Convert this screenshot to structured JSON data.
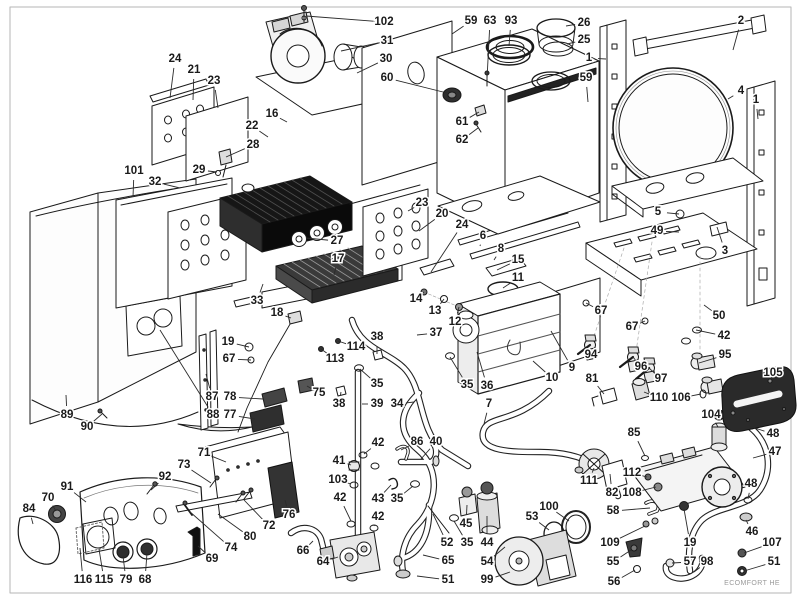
{
  "diagram": {
    "watermark": "ECOMFORT HE",
    "colors": {
      "ink": "#1a1a1a",
      "leader": "#2b2b2b",
      "halo": "#ffffff",
      "dark_part": "#262626",
      "border": "#b5b5b5"
    },
    "label_font_px": 11.5,
    "callouts": [
      {
        "n": "24",
        "x": 175,
        "y": 59,
        "tx": 170,
        "ty": 98
      },
      {
        "n": "21",
        "x": 194,
        "y": 70,
        "tx": 193,
        "ty": 100
      },
      {
        "n": "23",
        "x": 214,
        "y": 81,
        "tx": 218,
        "ty": 108
      },
      {
        "n": "102",
        "x": 384,
        "y": 22,
        "tx": 306,
        "ty": 16
      },
      {
        "n": "31",
        "x": 387,
        "y": 41,
        "tx": 341,
        "ty": 51
      },
      {
        "n": "30",
        "x": 386,
        "y": 59,
        "tx": 357,
        "ty": 73
      },
      {
        "n": "60",
        "x": 387,
        "y": 78,
        "tx": 447,
        "ty": 93
      },
      {
        "n": "59",
        "x": 471,
        "y": 21,
        "tx": 452,
        "ty": 34
      },
      {
        "n": "63",
        "x": 490,
        "y": 21,
        "tx": 487,
        "ty": 79
      },
      {
        "n": "93",
        "x": 511,
        "y": 21,
        "tx": 509,
        "ty": 46
      },
      {
        "n": "26",
        "x": 584,
        "y": 23,
        "tx": 566,
        "ty": 26
      },
      {
        "n": "25",
        "x": 584,
        "y": 40,
        "tx": 567,
        "ty": 44
      },
      {
        "n": "1",
        "x": 589,
        "y": 58,
        "tx": 606,
        "ty": 59
      },
      {
        "n": "59",
        "x": 586,
        "y": 78,
        "tx": 588,
        "ty": 102
      },
      {
        "n": "2",
        "x": 741,
        "y": 21,
        "tx": 733,
        "ty": 50
      },
      {
        "n": "4",
        "x": 741,
        "y": 91,
        "tx": 728,
        "ty": 99
      },
      {
        "n": "1",
        "x": 756,
        "y": 100,
        "tx": 758,
        "ty": 119
      },
      {
        "n": "16",
        "x": 272,
        "y": 114,
        "tx": 287,
        "ty": 122
      },
      {
        "n": "22",
        "x": 252,
        "y": 126,
        "tx": 268,
        "ty": 137
      },
      {
        "n": "28",
        "x": 253,
        "y": 145,
        "tx": 226,
        "ty": 157
      },
      {
        "n": "29",
        "x": 199,
        "y": 170,
        "tx": 217,
        "ty": 172
      },
      {
        "n": "101",
        "x": 134,
        "y": 171,
        "tx": 133,
        "ty": 197
      },
      {
        "n": "32",
        "x": 155,
        "y": 182,
        "tx": 180,
        "ty": 188
      },
      {
        "n": "61",
        "x": 462,
        "y": 122,
        "tx": 479,
        "ty": 112
      },
      {
        "n": "62",
        "x": 462,
        "y": 140,
        "tx": 478,
        "ty": 128
      },
      {
        "n": "5",
        "x": 658,
        "y": 212,
        "tx": 679,
        "ty": 214
      },
      {
        "n": "49",
        "x": 657,
        "y": 231,
        "tx": 679,
        "ty": 232
      },
      {
        "n": "3",
        "x": 725,
        "y": 251,
        "tx": 717,
        "ty": 227
      },
      {
        "n": "27",
        "x": 337,
        "y": 241,
        "tx": 306,
        "ty": 238
      },
      {
        "n": "23",
        "x": 422,
        "y": 203,
        "tx": 408,
        "ty": 211
      },
      {
        "n": "20",
        "x": 442,
        "y": 214,
        "tx": 419,
        "ty": 231
      },
      {
        "n": "24",
        "x": 462,
        "y": 225,
        "tx": 431,
        "ty": 272
      },
      {
        "n": "6",
        "x": 483,
        "y": 236,
        "tx": 480,
        "ty": 246
      },
      {
        "n": "8",
        "x": 501,
        "y": 249,
        "tx": 494,
        "ty": 260
      },
      {
        "n": "15",
        "x": 518,
        "y": 260,
        "tx": 497,
        "ty": 270
      },
      {
        "n": "11",
        "x": 518,
        "y": 278,
        "tx": 503,
        "ty": 288
      },
      {
        "n": "17",
        "x": 338,
        "y": 259,
        "tx": 334,
        "ty": 275
      },
      {
        "n": "33",
        "x": 257,
        "y": 301,
        "tx": 263,
        "ty": 284
      },
      {
        "n": "18",
        "x": 277,
        "y": 313,
        "tx": 291,
        "ty": 318
      },
      {
        "n": "14",
        "x": 416,
        "y": 299,
        "tx": 424,
        "ty": 292
      },
      {
        "n": "13",
        "x": 435,
        "y": 311,
        "tx": 444,
        "ty": 299
      },
      {
        "n": "12",
        "x": 455,
        "y": 322,
        "tx": 459,
        "ty": 307
      },
      {
        "n": "37",
        "x": 436,
        "y": 333,
        "tx": 417,
        "ty": 335
      },
      {
        "n": "19",
        "x": 228,
        "y": 342,
        "tx": 249,
        "ty": 347
      },
      {
        "n": "67",
        "x": 229,
        "y": 359,
        "tx": 251,
        "ty": 360
      },
      {
        "n": "38",
        "x": 377,
        "y": 337,
        "tx": 377,
        "ty": 354
      },
      {
        "n": "114",
        "x": 356,
        "y": 347,
        "tx": 338,
        "ty": 341
      },
      {
        "n": "113",
        "x": 335,
        "y": 359,
        "tx": 321,
        "ty": 349
      },
      {
        "n": "75",
        "x": 319,
        "y": 393,
        "tx": 307,
        "ty": 386
      },
      {
        "n": "35",
        "x": 377,
        "y": 384,
        "tx": 360,
        "ty": 369
      },
      {
        "n": "38",
        "x": 339,
        "y": 404,
        "tx": 341,
        "ty": 392
      },
      {
        "n": "39",
        "x": 377,
        "y": 404,
        "tx": 362,
        "ty": 404
      },
      {
        "n": "34",
        "x": 397,
        "y": 404,
        "tx": 414,
        "ty": 402
      },
      {
        "n": "35",
        "x": 467,
        "y": 385,
        "tx": 450,
        "ty": 357
      },
      {
        "n": "36",
        "x": 487,
        "y": 386,
        "tx": 477,
        "ty": 352
      },
      {
        "n": "10",
        "x": 552,
        "y": 378,
        "tx": 533,
        "ty": 361
      },
      {
        "n": "9",
        "x": 572,
        "y": 368,
        "tx": 551,
        "ty": 331
      },
      {
        "n": "7",
        "x": 489,
        "y": 404,
        "tx": 484,
        "ty": 424
      },
      {
        "n": "50",
        "x": 719,
        "y": 316,
        "tx": 704,
        "ty": 305
      },
      {
        "n": "67",
        "x": 601,
        "y": 311,
        "tx": 586,
        "ty": 303
      },
      {
        "n": "67",
        "x": 632,
        "y": 327,
        "tx": 645,
        "ty": 321
      },
      {
        "n": "42",
        "x": 724,
        "y": 336,
        "tx": 696,
        "ty": 330
      },
      {
        "n": "94",
        "x": 591,
        "y": 355,
        "tx": 590,
        "ty": 345
      },
      {
        "n": "96",
        "x": 641,
        "y": 367,
        "tx": 633,
        "ty": 357
      },
      {
        "n": "97",
        "x": 661,
        "y": 379,
        "tx": 649,
        "ty": 368
      },
      {
        "n": "95",
        "x": 725,
        "y": 355,
        "tx": 699,
        "ty": 363
      },
      {
        "n": "81",
        "x": 592,
        "y": 379,
        "tx": 604,
        "ty": 394
      },
      {
        "n": "110",
        "x": 659,
        "y": 398,
        "tx": 644,
        "ty": 392
      },
      {
        "n": "106",
        "x": 681,
        "y": 398,
        "tx": 701,
        "ty": 394
      },
      {
        "n": "104",
        "x": 711,
        "y": 415,
        "tx": 718,
        "ty": 427
      },
      {
        "n": "105",
        "x": 773,
        "y": 373,
        "tx": 756,
        "ty": 384
      },
      {
        "n": "87",
        "x": 212,
        "y": 397,
        "tx": 206,
        "ty": 374
      },
      {
        "n": "88",
        "x": 213,
        "y": 415,
        "tx": 160,
        "ty": 330
      },
      {
        "n": "78",
        "x": 230,
        "y": 397,
        "tx": 263,
        "ty": 399
      },
      {
        "n": "77",
        "x": 230,
        "y": 415,
        "tx": 255,
        "ty": 419
      },
      {
        "n": "89",
        "x": 67,
        "y": 415,
        "tx": 66,
        "ty": 395
      },
      {
        "n": "90",
        "x": 87,
        "y": 427,
        "tx": 102,
        "ty": 414
      },
      {
        "n": "71",
        "x": 204,
        "y": 453,
        "tx": 226,
        "ty": 462
      },
      {
        "n": "73",
        "x": 184,
        "y": 465,
        "tx": 211,
        "ty": 483
      },
      {
        "n": "92",
        "x": 165,
        "y": 477,
        "tx": 151,
        "ty": 490
      },
      {
        "n": "91",
        "x": 67,
        "y": 487,
        "tx": 86,
        "ty": 502
      },
      {
        "n": "70",
        "x": 48,
        "y": 498,
        "tx": 56,
        "ty": 511
      },
      {
        "n": "84",
        "x": 29,
        "y": 509,
        "tx": 33,
        "ty": 524
      },
      {
        "n": "76",
        "x": 289,
        "y": 515,
        "tx": 285,
        "ty": 500
      },
      {
        "n": "72",
        "x": 269,
        "y": 526,
        "tx": 244,
        "ty": 500
      },
      {
        "n": "80",
        "x": 250,
        "y": 537,
        "tx": 218,
        "ty": 514
      },
      {
        "n": "74",
        "x": 231,
        "y": 548,
        "tx": 189,
        "ty": 511
      },
      {
        "n": "69",
        "x": 212,
        "y": 559,
        "tx": 198,
        "ty": 546
      },
      {
        "n": "116",
        "x": 83,
        "y": 580,
        "tx": 80,
        "ty": 548
      },
      {
        "n": "115",
        "x": 104,
        "y": 580,
        "tx": 99,
        "ty": 549
      },
      {
        "n": "79",
        "x": 126,
        "y": 580,
        "tx": 123,
        "ty": 556
      },
      {
        "n": "68",
        "x": 145,
        "y": 580,
        "tx": 147,
        "ty": 553
      },
      {
        "n": "42",
        "x": 378,
        "y": 443,
        "tx": 364,
        "ty": 454
      },
      {
        "n": "86",
        "x": 417,
        "y": 442,
        "tx": 401,
        "ty": 450
      },
      {
        "n": "40",
        "x": 436,
        "y": 442,
        "tx": 421,
        "ty": 459
      },
      {
        "n": "41",
        "x": 339,
        "y": 461,
        "tx": 351,
        "ty": 465
      },
      {
        "n": "103",
        "x": 338,
        "y": 480,
        "tx": 351,
        "ty": 484
      },
      {
        "n": "43",
        "x": 378,
        "y": 499,
        "tx": 391,
        "ty": 485
      },
      {
        "n": "35",
        "x": 397,
        "y": 499,
        "tx": 413,
        "ty": 486
      },
      {
        "n": "42",
        "x": 340,
        "y": 498,
        "tx": 351,
        "ty": 521
      },
      {
        "n": "42",
        "x": 378,
        "y": 517,
        "tx": 374,
        "ty": 526
      },
      {
        "n": "66",
        "x": 303,
        "y": 551,
        "tx": 313,
        "ty": 541
      },
      {
        "n": "64",
        "x": 323,
        "y": 562,
        "tx": 338,
        "ty": 557
      },
      {
        "n": "65",
        "x": 448,
        "y": 561,
        "tx": 423,
        "ty": 555
      },
      {
        "n": "51",
        "x": 448,
        "y": 580,
        "tx": 417,
        "ty": 576
      },
      {
        "n": "52",
        "x": 447,
        "y": 543,
        "tx": 433,
        "ty": 514
      },
      {
        "n": "35",
        "x": 467,
        "y": 543,
        "tx": 454,
        "ty": 521
      },
      {
        "n": "45",
        "x": 466,
        "y": 524,
        "tx": 467,
        "ty": 505
      },
      {
        "n": "44",
        "x": 487,
        "y": 543,
        "tx": 487,
        "ty": 516
      },
      {
        "n": "54",
        "x": 487,
        "y": 562,
        "tx": 505,
        "ty": 547
      },
      {
        "n": "99",
        "x": 487,
        "y": 580,
        "tx": 510,
        "ty": 572
      },
      {
        "n": "100",
        "x": 549,
        "y": 507,
        "tx": 569,
        "ty": 521
      },
      {
        "n": "53",
        "x": 532,
        "y": 517,
        "tx": 549,
        "ty": 530
      },
      {
        "n": "85",
        "x": 634,
        "y": 433,
        "tx": 645,
        "ty": 456
      },
      {
        "n": "112",
        "x": 632,
        "y": 473,
        "tx": 647,
        "ty": 477
      },
      {
        "n": "108",
        "x": 632,
        "y": 493,
        "tx": 656,
        "ty": 487
      },
      {
        "n": "111",
        "x": 589,
        "y": 481,
        "tx": 594,
        "ty": 468
      },
      {
        "n": "82",
        "x": 612,
        "y": 493,
        "tx": 610,
        "ty": 474
      },
      {
        "n": "58",
        "x": 613,
        "y": 511,
        "tx": 650,
        "ty": 508
      },
      {
        "n": "109",
        "x": 610,
        "y": 543,
        "tx": 645,
        "ty": 526
      },
      {
        "n": "19",
        "x": 690,
        "y": 543,
        "tx": 684,
        "ty": 509
      },
      {
        "n": "55",
        "x": 613,
        "y": 562,
        "tx": 631,
        "ty": 550
      },
      {
        "n": "56",
        "x": 614,
        "y": 582,
        "tx": 635,
        "ty": 570
      },
      {
        "n": "57",
        "x": 690,
        "y": 562,
        "tx": 672,
        "ty": 563
      },
      {
        "n": "98",
        "x": 707,
        "y": 562,
        "tx": 694,
        "ty": 572
      },
      {
        "n": "51",
        "x": 774,
        "y": 562,
        "tx": 744,
        "ty": 571
      },
      {
        "n": "107",
        "x": 772,
        "y": 543,
        "tx": 744,
        "ty": 553
      },
      {
        "n": "46",
        "x": 752,
        "y": 532,
        "tx": 746,
        "ty": 520
      },
      {
        "n": "48",
        "x": 751,
        "y": 484,
        "tx": 748,
        "ty": 499
      },
      {
        "n": "47",
        "x": 775,
        "y": 452,
        "tx": 753,
        "ty": 458
      },
      {
        "n": "48",
        "x": 773,
        "y": 434,
        "tx": 752,
        "ty": 427
      }
    ]
  }
}
